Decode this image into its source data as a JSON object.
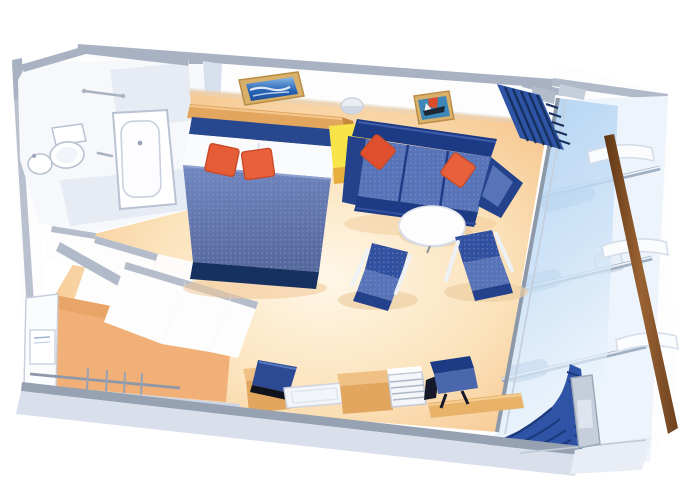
{
  "meta": {
    "title": "Cruise ship stateroom with private balcony — 3D cutaway floor plan",
    "view": "overhead cutaway rendering, no visible text"
  },
  "palette": {
    "wallWhite": "#fdfdfe",
    "wallCap": "#a8b2c2",
    "wallShadow": "#d8e0ee",
    "floorEdge": "#f2b377",
    "floorMid": "#fbe2ba",
    "floorCenter": "#fff7e8",
    "navy": "#1d3a85",
    "navyDark": "#16305f",
    "headboardNavy": "#27478f",
    "cushionBlue": "#5873b8",
    "duvetTop": "#7388c2",
    "duvetBottom": "#56699e",
    "duvetDot": "#93a6d4",
    "orange": "#e55c36",
    "orangeDark": "#c84a28",
    "wood": "#e2a65f",
    "woodLight": "#f0c084",
    "woodDark": "#c9893d",
    "yellow": "#f7e448",
    "yellowSide": "#e5ae3e",
    "glassTop": "#bcd8f2",
    "glassBottom": "#e9f3fc",
    "railBrown": "#8a5a2e",
    "railBrownDark": "#5e3514",
    "bandGray": "#d9e0ec",
    "bandCap": "#96a1b1",
    "frameTan": "#d9b06a",
    "artBlue": "#2a65b8",
    "artSky": "#86b7e4",
    "curtain": "#2f54a5",
    "curtainDark": "#1c3a7d",
    "fixture": "#f6f8fb",
    "fixtureLine": "#c3cad6",
    "deckWhite": "#eef4fb",
    "silhouette": "#b7cce2"
  },
  "scene": {
    "labels": {
      "room": "Stateroom with balcony floor plan",
      "bathroom": "Bathroom",
      "bathtub": "Bathtub",
      "toilet": "Toilet",
      "sink": "Washbasin",
      "towel_bar": "Towel bar",
      "entry": "Entry door",
      "wardrobe": "Wardrobe with hanging rail and hangers",
      "wardrobe_doors": "Angled wardrobe doors",
      "safe": "Safe / shelf unit",
      "bed": "Double bed with blue bedspread",
      "bed_cushions": "Two orange accent cushions",
      "artwork_bed": "Framed seascape artwork",
      "artwork_sofa": "Framed sailboat artwork",
      "wall_light": "Wall light",
      "nightstand": "Yellow side table",
      "sofa": "Blue sofa with orange cushions",
      "coffee_table": "Round white table",
      "chair_left": "Blue armchair",
      "chair_right": "Blue armchair",
      "tv": "Television on cabinet",
      "tv_cabinet": "TV cabinet",
      "glass_tray": "Glass tray",
      "desk": "Desk / vanity unit",
      "minibar": "Minibar drawer unit",
      "desk_chair": "Blue desk chair",
      "desktop": "Wooden desktop",
      "curtain_top": "Curtain (balcony door, head end)",
      "curtain_bottom": "Curtain (balcony door, desk end)",
      "balcony": "Private balcony",
      "balcony_glass": "Floor-to-ceiling glass partition",
      "balcony_rails": "Balcony glass rails",
      "balcony_furniture": "Balcony chairs and table",
      "balcony_dividers": "Balcony divider panels",
      "railing": "Wooden balcony railing",
      "door_post": "Balcony door frame",
      "bottom_wall": "Lower cabin wall",
      "top_wall": "Upper cabin wall"
    }
  }
}
